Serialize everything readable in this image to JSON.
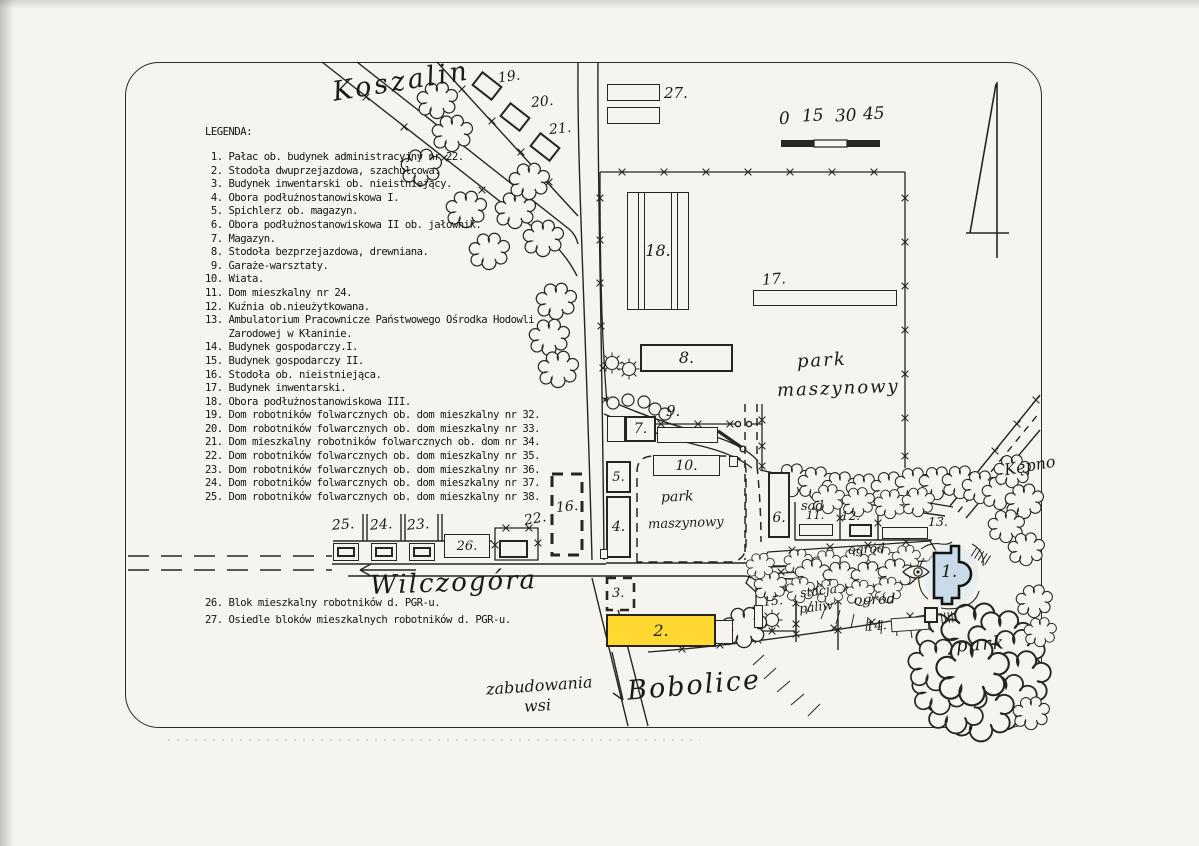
{
  "legend": {
    "title": "LEGENDA:",
    "items": [
      " 1. Pałac ob. budynek administracyjny nr 22.",
      " 2. Stodoła dwuprzejazdowa, szachulcowa.",
      " 3. Budynek inwentarski ob. nieistniejący.",
      " 4. Obora podłużnostanowiskowa I.",
      " 5. Spichlerz ob. magazyn.",
      " 6. Obora podłużnostanowiskowa II ob. jałownik.",
      " 7. Magazyn.",
      " 8. Stodoła bezprzejazdowa, drewniana.",
      " 9. Garaże-warsztaty.",
      "10. Wiata.",
      "11. Dom mieszkalny nr 24.",
      "12. Kuźnia ob.nieużytkowana.",
      "13. Ambulatorium Pracownicze Państwowego Ośrodka Hodowli",
      "    Zarodowej w Kłaninie.",
      "14. Budynek gospodarczy.I.",
      "15. Budynek gospodarczy II.",
      "16. Stodoła ob. nieistniejąca.",
      "17. Budynek inwentarski.",
      "18. Obora podłużnostanowiskowa III.",
      "19. Dom robotników folwarcznych ob. dom mieszkalny nr 32.",
      "20. Dom robotników folwarcznych ob. dom mieszkalny nr 33.",
      "21. Dom mieszkalny robotników folwarcznych ob. dom nr 34.",
      "22. Dom robotników folwarcznych ob. dom mieszkalny nr 35.",
      "23. Dom robotników folwarcznych ob. dom mieszkalny nr 36.",
      "24. Dom robotników folwarcznych ob. dom mieszkalny nr 37.",
      "25. Dom robotników folwarcznych ob. dom mieszkalny nr 38."
    ],
    "items_bottom": [
      "26. Blok mieszkalny robotników d. PGR-u.",
      "27. Osiedle bloków mieszkalnych robotników d. PGR-u."
    ]
  },
  "scale_bar": {
    "ticks": [
      "0",
      "15",
      "30",
      "45"
    ]
  },
  "places": {
    "koszalin": "Koszalin",
    "wilczogora": "Wilczogóra",
    "bobolice": "Bobolice",
    "kepno": "Kępno",
    "zabudowania_1": "zabudowania",
    "zabudowania_2": "wsi"
  },
  "areas": {
    "park_upper_1": "park",
    "park_upper_2": "maszynowy",
    "park_lower_1": "park",
    "park_lower_2": "maszynowy",
    "sad": "sad",
    "ogrod_1": "ogród",
    "ogrod_2": "ogród",
    "stacja_1": "stacja",
    "stacja_2": "paliw",
    "park": "park"
  },
  "buildings": {
    "b1": "1.",
    "b2": "2.",
    "b3": "3.",
    "b4": "4.",
    "b5": "5.",
    "b6": "6.",
    "b7": "7.",
    "b8": "8.",
    "b9": "9.",
    "b10": "10.",
    "b11": "11.",
    "b12": "12.",
    "b13": "13.",
    "b14": "14.",
    "b15": "15.",
    "b16": "16.",
    "b17": "17.",
    "b18": "18.",
    "b19": "19.",
    "b20": "20.",
    "b21": "21.",
    "b22": "22.",
    "b23": "23.",
    "b24": "24.",
    "b25": "25.",
    "b26": "26.",
    "b27": "27."
  },
  "colors": {
    "highlight_yellow": "#ffd832",
    "highlight_blue": "#c9dbe9",
    "ink": "#26261f",
    "paper": "#f6f4ef"
  }
}
